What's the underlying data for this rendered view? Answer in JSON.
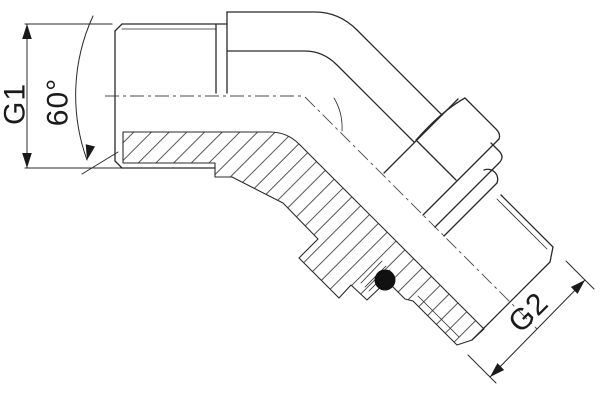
{
  "drawing": {
    "kind": "technical line drawing, 60-degree adjustable elbow fitting, half-section view",
    "labels": {
      "g1_thread": "G1",
      "bend_angle": "60°",
      "g2_thread": "G2"
    },
    "colors": {
      "line": "#2a2a2a",
      "background": "#ffffff",
      "o_ring": "#111111"
    }
  }
}
